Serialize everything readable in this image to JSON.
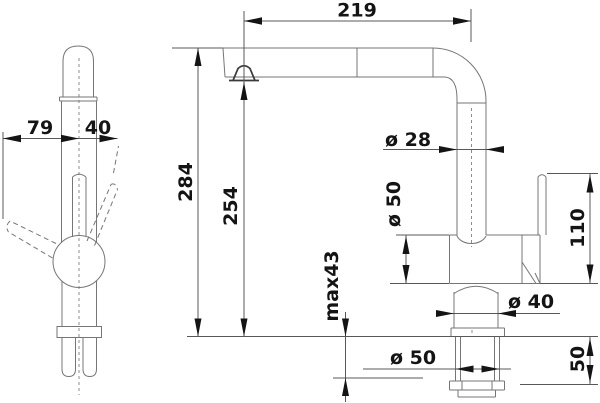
{
  "dims": {
    "front": {
      "reach_left": "79",
      "reach_right": "40"
    },
    "side": {
      "spout_reach": "219",
      "overall_height": "284",
      "outlet_height": "254",
      "spout_tube_diameter": "ø 28",
      "body_diameter": "ø 50",
      "lever_section_height": "110",
      "max_counter_thickness": "max43",
      "neck_diameter": "ø 40",
      "shank_diameter": "ø 50",
      "under_counter_length": "50"
    }
  },
  "colors": {
    "background": "#ffffff",
    "part_line": "#767676",
    "dimension_line": "#585858",
    "label": "#141414"
  }
}
